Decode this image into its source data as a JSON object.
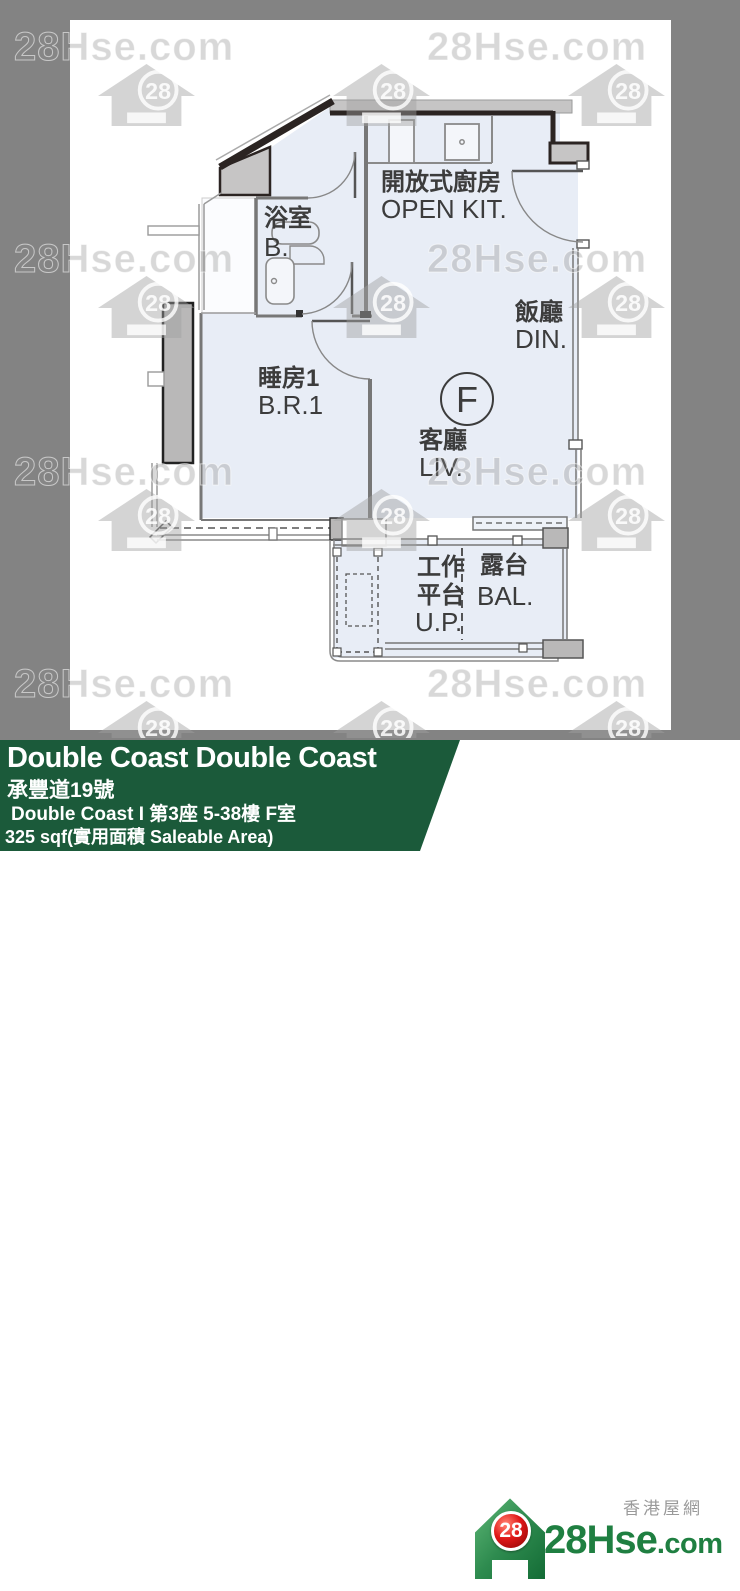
{
  "watermark": {
    "text": "28Hse.com",
    "badge": "28"
  },
  "plan": {
    "unit_marker": "F",
    "rooms": {
      "kitchen": {
        "cn": "開放式廚房",
        "en": "OPEN KIT."
      },
      "dining": {
        "cn": "飯廳",
        "en": "DIN."
      },
      "bath": {
        "cn": "浴室",
        "en": "B."
      },
      "bedroom": {
        "cn": "睡房1",
        "en": "B.R.1"
      },
      "living": {
        "cn": "客廳",
        "en": "LIV."
      },
      "utility": {
        "cn_line1": "工作",
        "cn_line2": "平台",
        "en": "U.P."
      },
      "balcony": {
        "cn": "露台",
        "en": "BAL."
      }
    }
  },
  "infobar": {
    "title": "Double Coast Double Coast",
    "address_cn": "承豐道19號",
    "unit_line": "Double Coast I 第3座 5-38樓 F室",
    "area_line": "325 sqf(實用面積 Saleable Area)"
  },
  "logo": {
    "badge": "28",
    "brand": "28Hse",
    "brand_suffix": ".com",
    "tagline": "香港屋網"
  },
  "colors": {
    "bar_green": "#1b5a3a",
    "logo_green": "#1f7f41",
    "badge_red": "#cc1414",
    "room_fill": "#e8edf6",
    "wall_dark": "#2b2422",
    "wall_gray": "#c6c5c5"
  }
}
